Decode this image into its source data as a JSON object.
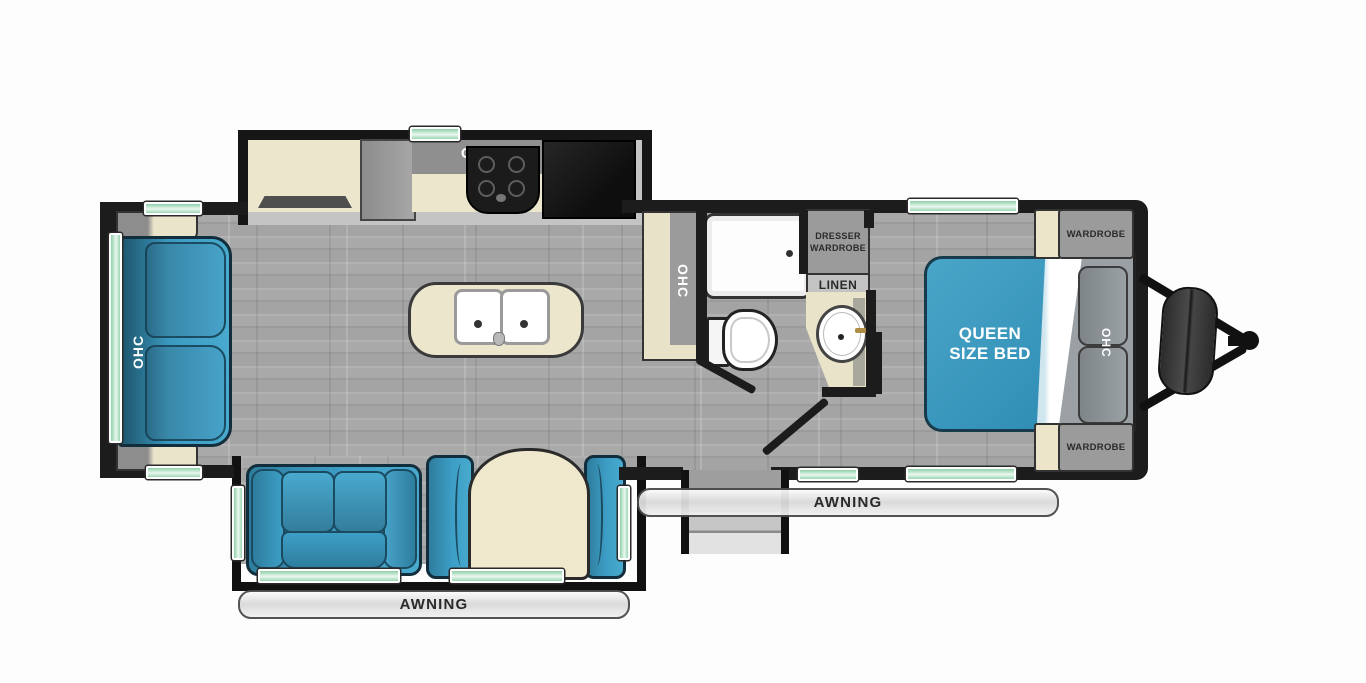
{
  "diagram": {
    "type": "travel-trailer-floorplan",
    "labels": {
      "kitchen_ohc": "OHC",
      "rear_sofa_ohc": "OHC",
      "hall_cabinet_ohc": "OHC",
      "bedroom_ohc": "OHC",
      "queen_bed": [
        "QUEEN",
        "SIZE BED"
      ],
      "dresser_wardrobe": [
        "DRESSER",
        "WARDROBE"
      ],
      "linen": "LINEN",
      "wardrobe_top": "WARDROBE",
      "wardrobe_bottom": "WARDROBE",
      "awning_main": "AWNING",
      "awning_door_side": "AWNING"
    },
    "colors": {
      "furniture_blue": "#3598c0",
      "bed_teal": "#3a9cc1",
      "cabinet_gray": "#9b9b9b",
      "counter_cream": "#ece6cd",
      "window_green": "#a8d9bb",
      "wall_black": "#1c1c1c",
      "floor_gray": "#a6a6a6"
    }
  }
}
